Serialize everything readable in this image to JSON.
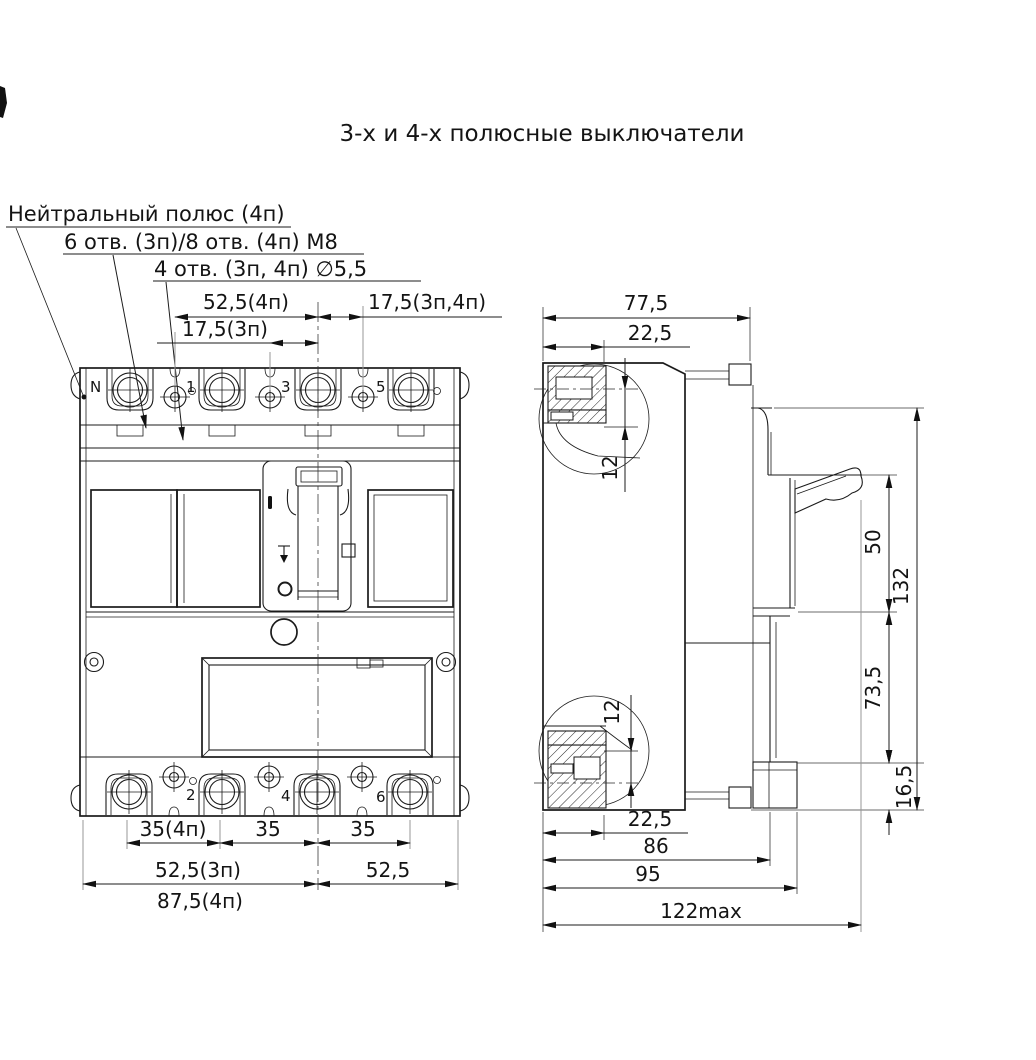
{
  "title": "3-х и 4-х полюсные выключатели",
  "callouts": {
    "neutral_pole": "Нейтральный полюс (4п)",
    "m8_holes": "6 отв. (3п)/8 отв. (4п) М8",
    "d55_holes": "4 отв. (3п, 4п) ∅5,5"
  },
  "front_view": {
    "pole_top": {
      "n": "N",
      "p1": "1",
      "p3": "3",
      "p5": "5"
    },
    "pole_bottom": {
      "p2": "2",
      "p4": "4",
      "p6": "6"
    },
    "dims": {
      "d525_4p": "52,5(4п)",
      "d175_3p4p": "17,5(3п,4п)",
      "d175_3p": "17,5(3п)",
      "d35_4p": "35(4п)",
      "d35_a": "35",
      "d35_b": "35",
      "d525_3p": "52,5(3п)",
      "d875_4p": "87,5(4п)",
      "d525": "52,5"
    }
  },
  "side_view": {
    "dims": {
      "d775": "77,5",
      "d225_top": "22,5",
      "d12_top": "12",
      "d12_bot": "12",
      "d50": "50",
      "d132": "132",
      "d735": "73,5",
      "d165": "16,5",
      "d225_bot": "22,5",
      "d86": "86",
      "d95": "95",
      "d122": "122max"
    }
  }
}
